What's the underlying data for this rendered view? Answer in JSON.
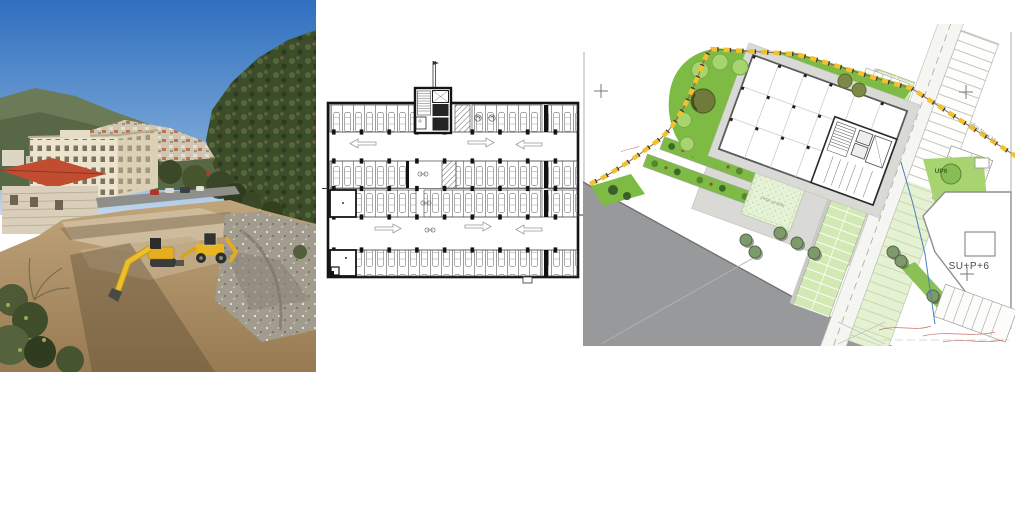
{
  "page": {
    "background": "#ffffff"
  },
  "panels": {
    "photo": {
      "name": "construction-site-photo",
      "colors": {
        "sky_top": "#2f6fbe",
        "sky_horizon": "#c3d9ee",
        "mountain": "#5f6e4c",
        "hill_dark": "#3c4d2a",
        "town": "#cfc7b4",
        "building_cream": "#ece4cd",
        "roof_red": "#c14c30",
        "dirt": "#b89a6f",
        "gravel": "#cdbb9b",
        "rubble_gray": "#a29c8e",
        "machine_yellow": "#e8b424",
        "shadow": "#5f4f38"
      }
    },
    "floor_plan": {
      "name": "parking-garage-floor-plan",
      "colors": {
        "ink": "#141414",
        "line_gray": "#555555"
      }
    },
    "site_plan": {
      "name": "landscaped-site-plan",
      "labels": {
        "building": "SU+P+6",
        "tree_tag": "UP6",
        "street": "ulica Nova 13",
        "playground": "Dečje igralište"
      },
      "colors": {
        "green": "#7dbb45",
        "grass_stall": "#d3e9b4",
        "pale_green": "#e7f3d8",
        "road_gray": "#97999b",
        "path_gray": "#d9d9d5",
        "boundary_yellow": "#f2c22e",
        "boundary_tick": "#3a3a36",
        "tree_olive": "#6e7b3a",
        "tree_light": "#a6d46e",
        "utility_blue": "#4a7fc0",
        "contour_red": "#c4756a",
        "wall_ink": "#5b5b5e"
      }
    }
  }
}
